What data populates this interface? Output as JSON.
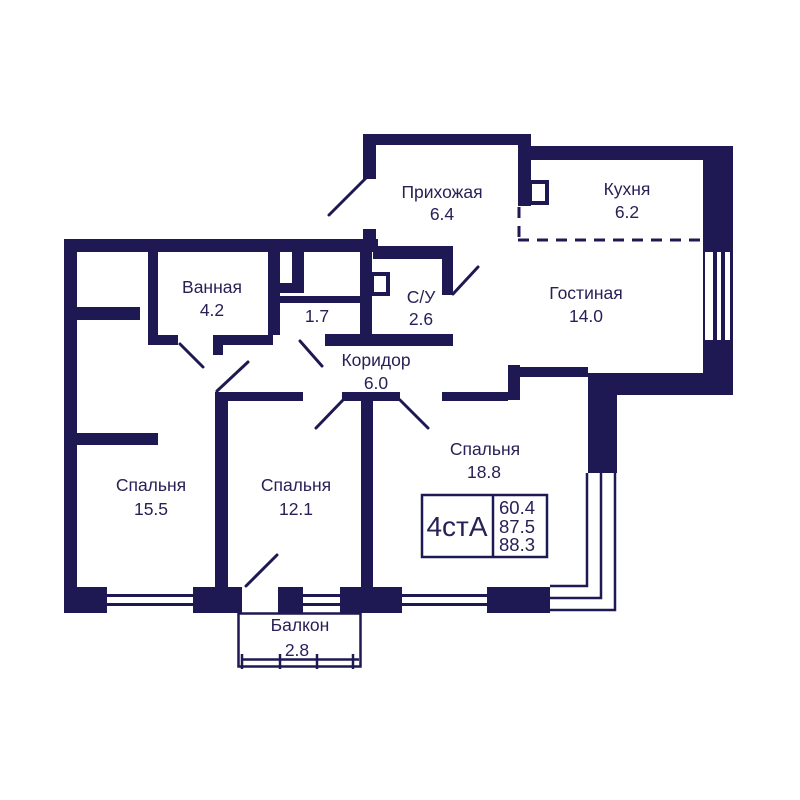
{
  "colors": {
    "wall": "#1e1853",
    "text": "#272156",
    "bg": "#ffffff"
  },
  "rooms": [
    {
      "name": "Прихожая",
      "area": "6.4"
    },
    {
      "name": "Кухня",
      "area": "6.2"
    },
    {
      "name": "Гостиная",
      "area": "14.0"
    },
    {
      "name": "С/У",
      "area": "2.6"
    },
    {
      "name": "",
      "area": "1.7"
    },
    {
      "name": "Ванная",
      "area": "4.2"
    },
    {
      "name": "Коридор",
      "area": "6.0"
    },
    {
      "name": "Спальня",
      "area": "15.5"
    },
    {
      "name": "Спальня",
      "area": "12.1"
    },
    {
      "name": "Спальня",
      "area": "18.8"
    },
    {
      "name": "Балкон",
      "area": "2.8"
    }
  ],
  "plan_info": {
    "type": "4стА",
    "areas": [
      "60.4",
      "87.5",
      "88.3"
    ]
  }
}
